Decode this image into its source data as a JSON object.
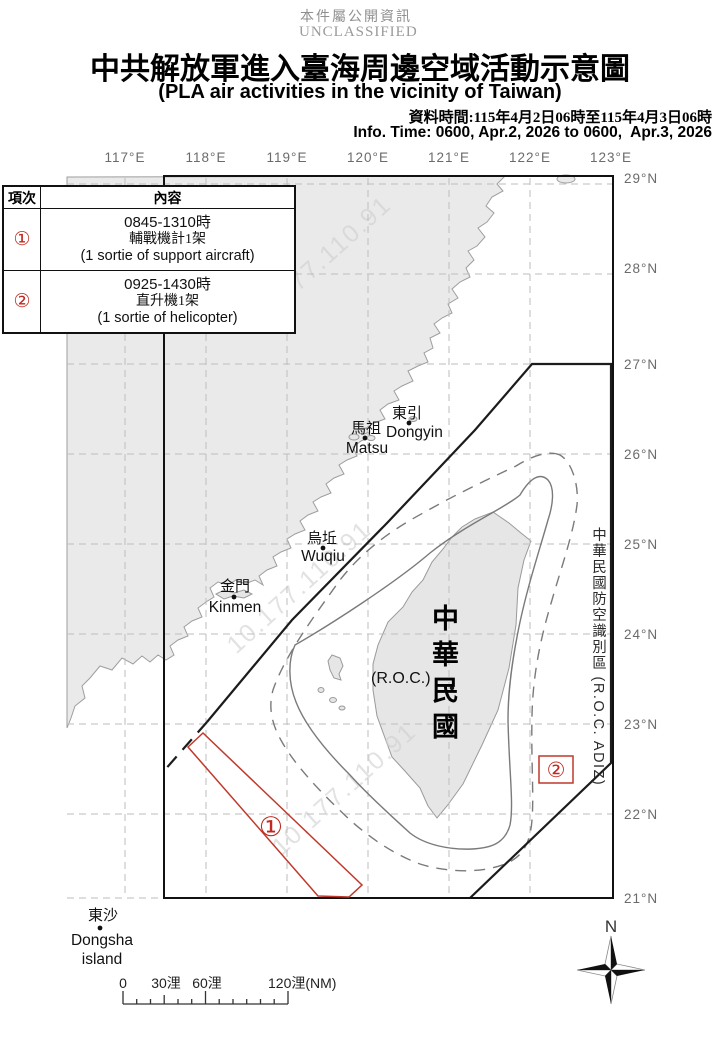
{
  "header": {
    "classification_zh": "本件屬公開資訊",
    "classification_en": "UNCLASSIFIED",
    "title_zh": "中共解放軍進入臺海周邊空域活動示意圖",
    "title_en": "(PLA air activities in the vicinity of Taiwan)",
    "data_time_zh": "資料時間:115年4月2日06時至115年4月3日06時",
    "info_time_en": "Info. Time: 0600, Apr.2, 2026 to 0600,  Apr.3, 2026"
  },
  "activity_table": {
    "col_item": "項次",
    "col_content": "內容",
    "rows": [
      {
        "num": "①",
        "time": "0845-1310時",
        "type_zh": "輔戰機計1架",
        "type_en": "(1 sortie of support aircraft)"
      },
      {
        "num": "②",
        "time": "0925-1430時",
        "type_zh": "直升機1架",
        "type_en": "(1 sortie of helicopter)"
      }
    ]
  },
  "map": {
    "lon_labels": [
      "117°E",
      "118°E",
      "119°E",
      "120°E",
      "121°E",
      "122°E",
      "123°E"
    ],
    "lat_labels": [
      "29°N",
      "28°N",
      "27°N",
      "26°N",
      "25°N",
      "24°N",
      "23°N",
      "22°N",
      "21°N"
    ],
    "places": {
      "dongyin_zh": "東引",
      "dongyin_en": "Dongyin",
      "matsu_zh": "馬祖",
      "matsu_en": "Matsu",
      "wuqiu_zh": "烏坵",
      "wuqiu_en": "Wuqiu",
      "kinmen_zh": "金門",
      "kinmen_en": "Kinmen",
      "dongsha_zh": "東沙",
      "dongsha_en1": "Dongsha",
      "dongsha_en2": "island"
    },
    "taiwan_label_zh": "中華民國",
    "taiwan_label_en": "(R.O.C.)",
    "adiz_label": "中華民國防空識別區 (R.O.C. ADIZ)",
    "marker1": "①",
    "marker2": "②",
    "watermark": "10.177.110.91",
    "compass_n": "N"
  },
  "scalebar": {
    "tick0": "0",
    "tick30": "30浬",
    "tick60": "60浬",
    "tick120": "120浬(NM)"
  },
  "colors": {
    "accent_red": "#bf2b20",
    "land_fill": "#eaeaea",
    "line_gray": "#7a7a7a"
  }
}
